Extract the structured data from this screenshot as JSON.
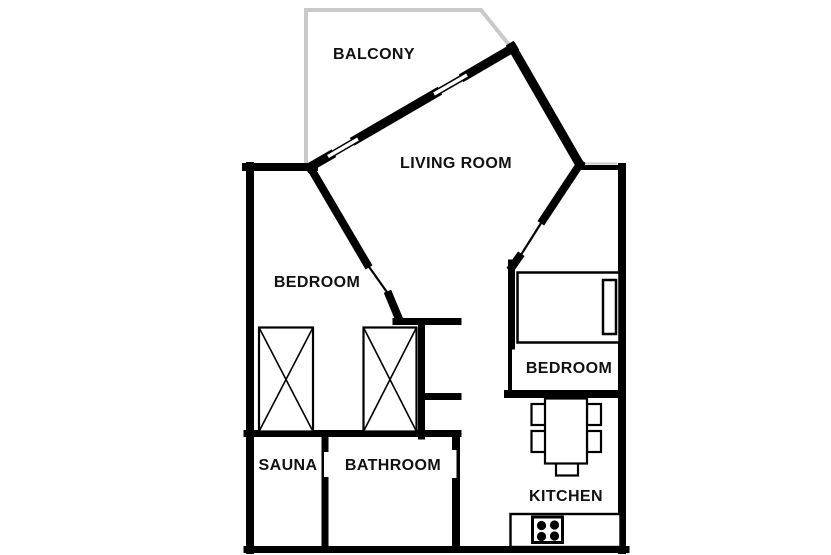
{
  "plan": {
    "title": "apartment-floor-plan",
    "colors": {
      "wall": "#000000",
      "balcony_outline": "#c9c9c9",
      "background": "#ffffff",
      "text": "#111111"
    },
    "rooms": {
      "balcony": {
        "label": "BALCONY"
      },
      "living_room": {
        "label": "LIVING ROOM"
      },
      "bedroom_left": {
        "label": "BEDROOM"
      },
      "bedroom_right": {
        "label": "BEDROOM"
      },
      "sauna": {
        "label": "SAUNA"
      },
      "bathroom": {
        "label": "BATHROOM"
      },
      "kitchen": {
        "label": "KITCHEN"
      }
    },
    "furniture": [
      {
        "name": "bed-with-pillow",
        "room": "bedroom_right"
      },
      {
        "name": "wardrobe-crossed",
        "room": "bedroom_left"
      },
      {
        "name": "wardrobe-crossed",
        "room": "bedroom_left"
      },
      {
        "name": "dining-table-with-five-chairs",
        "room": "kitchen"
      },
      {
        "name": "counter-with-stove-burners",
        "room": "kitchen"
      }
    ]
  }
}
